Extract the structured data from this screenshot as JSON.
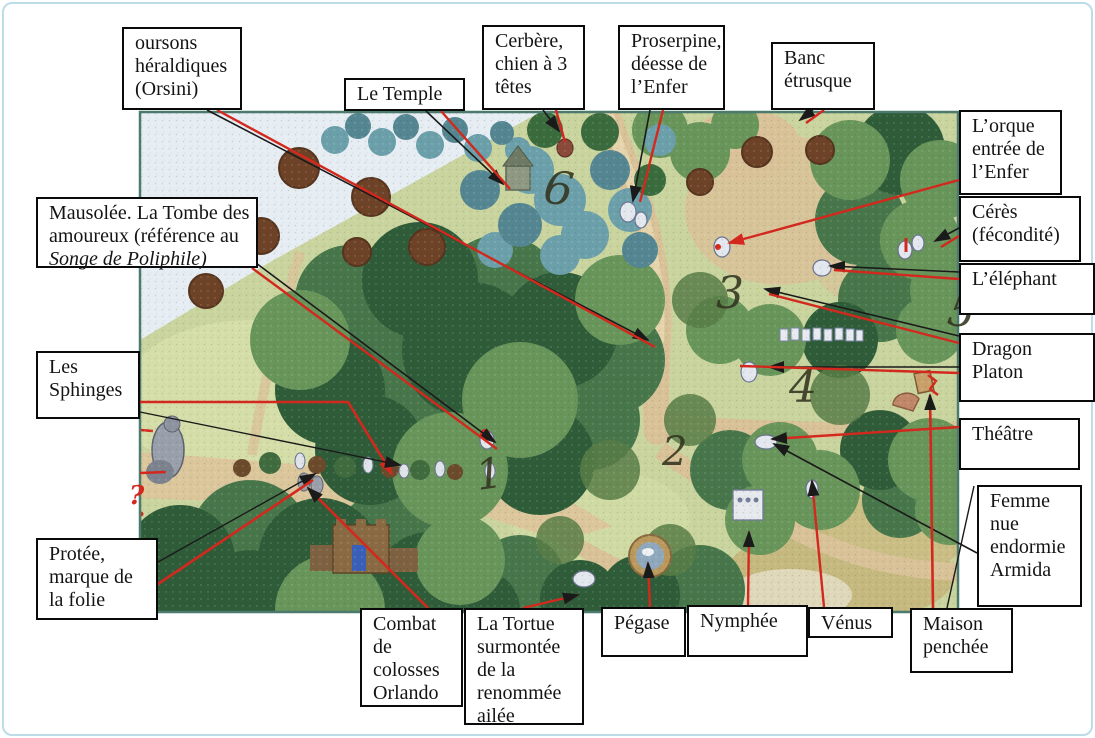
{
  "figure_type": "annotated garden map (scanned document page)",
  "colors": {
    "arrow_red": "#d3281e",
    "arrow_black": "#1a1a1a",
    "box_border": "#0a0a0a",
    "box_bg": "#ffffff",
    "frame_blue": "#bcdce9",
    "map_border": "#4d7a6e"
  },
  "map": {
    "x": 140,
    "y": 112,
    "w": 818,
    "h": 500,
    "numbers": [
      {
        "n": "1",
        "x": 478,
        "y": 490,
        "s": 42,
        "r": -8
      },
      {
        "n": "2",
        "x": 662,
        "y": 465,
        "s": 40,
        "r": 0
      },
      {
        "n": "3",
        "x": 716,
        "y": 308,
        "s": 44,
        "r": 0
      },
      {
        "n": "4",
        "x": 789,
        "y": 402,
        "s": 44,
        "r": 0
      },
      {
        "n": "5",
        "x": 946,
        "y": 324,
        "s": 42,
        "r": 10
      },
      {
        "n": "6",
        "x": 542,
        "y": 202,
        "s": 46,
        "r": 8
      }
    ],
    "question_mark": {
      "t": "?",
      "x": 129,
      "y": 504,
      "color": "#d3281e"
    }
  },
  "labels": [
    {
      "id": "oursons-heraldiques",
      "box": {
        "x": 122,
        "y": 27,
        "w": 120,
        "h": 83
      },
      "lines": [
        {
          "t": "oursons"
        },
        {
          "t": "héraldiques"
        },
        {
          "t": "(Orsini)"
        }
      ],
      "arrows": [
        {
          "c": "black",
          "w": 1.6,
          "pts": [
            [
              207,
              110
            ],
            [
              648,
              340
            ]
          ],
          "head": "black"
        },
        {
          "c": "red",
          "w": 2.4,
          "pts": [
            [
              217,
              110
            ],
            [
              655,
              347
            ]
          ],
          "head": null
        }
      ]
    },
    {
      "id": "le-temple",
      "box": {
        "x": 344,
        "y": 78,
        "w": 121,
        "h": 33
      },
      "lines": [
        {
          "t": "Le Temple"
        }
      ],
      "arrows": [
        {
          "c": "black",
          "w": 1.6,
          "pts": [
            [
              426,
              111
            ],
            [
              503,
              184
            ]
          ],
          "head": "black"
        },
        {
          "c": "red",
          "w": 2.4,
          "pts": [
            [
              441,
              111
            ],
            [
              510,
              189
            ]
          ],
          "head": null
        }
      ]
    },
    {
      "id": "cerbere",
      "box": {
        "x": 482,
        "y": 25,
        "w": 103,
        "h": 85
      },
      "lines": [
        {
          "t": "Cerbère,"
        },
        {
          "t": "chien à 3"
        },
        {
          "t": "têtes"
        }
      ],
      "arrows": [
        {
          "c": "black",
          "w": 1.6,
          "pts": [
            [
              543,
              110
            ],
            [
              559,
              131
            ]
          ],
          "head": "black"
        },
        {
          "c": "red",
          "w": 2.4,
          "pts": [
            [
              556,
              110
            ],
            [
              565,
              142
            ]
          ],
          "head": null
        }
      ]
    },
    {
      "id": "proserpine",
      "box": {
        "x": 618,
        "y": 25,
        "w": 107,
        "h": 85
      },
      "lines": [
        {
          "t": "Proserpine,"
        },
        {
          "t": "déesse de"
        },
        {
          "t": "l’Enfer"
        }
      ],
      "arrows": [
        {
          "c": "black",
          "w": 1.6,
          "pts": [
            [
              650,
              110
            ],
            [
              633,
              201
            ]
          ],
          "head": "black"
        },
        {
          "c": "red",
          "w": 2.4,
          "pts": [
            [
              663,
              110
            ],
            [
              640,
              202
            ]
          ],
          "head": null
        }
      ]
    },
    {
      "id": "banc-etrusque",
      "box": {
        "x": 771,
        "y": 42,
        "w": 104,
        "h": 68
      },
      "lines": [
        {
          "t": "Banc"
        },
        {
          "t": "étrusque"
        }
      ],
      "arrows": [
        {
          "c": "black",
          "w": 1.6,
          "pts": [
            [
              813,
              110
            ],
            [
              800,
              120
            ]
          ],
          "head": "black"
        },
        {
          "c": "red",
          "w": 2.4,
          "pts": [
            [
              824,
              110
            ],
            [
              806,
              123
            ]
          ],
          "head": null
        }
      ]
    },
    {
      "id": "l-orque",
      "box": {
        "x": 959,
        "y": 110,
        "w": 103,
        "h": 85
      },
      "lines": [
        {
          "t": "L’orque"
        },
        {
          "t": "entrée de"
        },
        {
          "t": "l’Enfer"
        }
      ],
      "arrows": [
        {
          "c": "red",
          "w": 2.4,
          "pts": [
            [
              959,
              180
            ],
            [
              729,
              243
            ]
          ],
          "head": "red"
        }
      ]
    },
    {
      "id": "ceres",
      "box": {
        "x": 959,
        "y": 196,
        "w": 122,
        "h": 66
      },
      "lines": [
        {
          "t": "Cérès"
        },
        {
          "t": "(fécondité)"
        }
      ],
      "arrows": [
        {
          "c": "black",
          "w": 1.6,
          "pts": [
            [
              959,
              228
            ],
            [
              935,
              241
            ]
          ],
          "head": "black"
        },
        {
          "c": "red",
          "w": 2.4,
          "pts": [
            [
              959,
              236
            ],
            [
              941,
              247
            ]
          ],
          "head": null
        }
      ]
    },
    {
      "id": "l-elephant",
      "box": {
        "x": 959,
        "y": 263,
        "w": 136,
        "h": 52
      },
      "lines": [
        {
          "t": "L’éléphant"
        }
      ],
      "arrows": [
        {
          "c": "black",
          "w": 1.6,
          "pts": [
            [
              959,
              272
            ],
            [
              830,
              266
            ]
          ],
          "head": "black"
        },
        {
          "c": "red",
          "w": 2.4,
          "pts": [
            [
              959,
              279
            ],
            [
              834,
              270
            ]
          ],
          "head": null
        }
      ]
    },
    {
      "id": "dragon-platon",
      "box": {
        "x": 959,
        "y": 333,
        "w": 136,
        "h": 69
      },
      "lines": [
        {
          "t": "Dragon"
        },
        {
          "t": "Platon"
        }
      ],
      "arrows": [
        {
          "c": "black",
          "w": 1.6,
          "pts": [
            [
              959,
              336
            ],
            [
              765,
              289
            ]
          ],
          "head": "black"
        },
        {
          "c": "red",
          "w": 2.4,
          "pts": [
            [
              959,
              343
            ],
            [
              769,
              294
            ]
          ],
          "head": null
        },
        {
          "c": "black",
          "w": 1.6,
          "pts": [
            [
              959,
              367
            ],
            [
              769,
              367
            ]
          ],
          "head": "black"
        },
        {
          "c": "red",
          "w": 2.4,
          "pts": [
            [
              959,
              373
            ],
            [
              740,
              366
            ]
          ],
          "head": null
        }
      ]
    },
    {
      "id": "theatre",
      "box": {
        "x": 959,
        "y": 418,
        "w": 121,
        "h": 52
      },
      "lines": [
        {
          "t": "Théâtre"
        }
      ],
      "arrows": [
        {
          "c": "red",
          "w": 2.4,
          "pts": [
            [
              959,
              427
            ],
            [
              772,
              439
            ]
          ],
          "head": "black"
        }
      ]
    },
    {
      "id": "femme-nue",
      "box": {
        "x": 977,
        "y": 485,
        "w": 105,
        "h": 122
      },
      "lines": [
        {
          "t": "Femme"
        },
        {
          "t": "nue"
        },
        {
          "t": "endormie"
        },
        {
          "t": "Armida"
        }
      ],
      "arrows": [
        {
          "c": "black",
          "w": 1.6,
          "pts": [
            [
              977,
              553
            ],
            [
              774,
              444
            ]
          ],
          "head": "black"
        }
      ]
    },
    {
      "id": "maison-penchee",
      "box": {
        "x": 910,
        "y": 608,
        "w": 103,
        "h": 65
      },
      "lines": [
        {
          "t": "Maison"
        },
        {
          "t": "penchée"
        }
      ],
      "arrows": [
        {
          "c": "red",
          "w": 2.6,
          "pts": [
            [
              933,
              608
            ],
            [
              930,
              395
            ]
          ],
          "head": "black"
        },
        {
          "c": "black",
          "w": 1.4,
          "pts": [
            [
              947,
              608
            ],
            [
              974,
              486
            ]
          ],
          "head": null
        }
      ]
    },
    {
      "id": "venus",
      "box": {
        "x": 808,
        "y": 607,
        "w": 85,
        "h": 31
      },
      "lines": [
        {
          "t": "Vénus"
        }
      ],
      "arrows": [
        {
          "c": "red",
          "w": 2.4,
          "pts": [
            [
              824,
              607
            ],
            [
              812,
              481
            ]
          ],
          "head": "black"
        }
      ]
    },
    {
      "id": "nymphee",
      "box": {
        "x": 687,
        "y": 605,
        "w": 121,
        "h": 52
      },
      "lines": [
        {
          "t": "Nymphée"
        }
      ],
      "arrows": [
        {
          "c": "red",
          "w": 2.4,
          "pts": [
            [
              748,
              605
            ],
            [
              749,
              532
            ]
          ],
          "head": "black"
        }
      ]
    },
    {
      "id": "pegase",
      "box": {
        "x": 601,
        "y": 607,
        "w": 85,
        "h": 50
      },
      "lines": [
        {
          "t": "Pégase"
        }
      ],
      "arrows": [
        {
          "c": "red",
          "w": 2.4,
          "pts": [
            [
              650,
              607
            ],
            [
              648,
              563
            ]
          ],
          "head": "black"
        }
      ]
    },
    {
      "id": "la-tortue",
      "box": {
        "x": 464,
        "y": 608,
        "w": 120,
        "h": 117
      },
      "lines": [
        {
          "t": "La Tortue"
        },
        {
          "t": "surmontée"
        },
        {
          "t": "de la"
        },
        {
          "t": "renommée"
        },
        {
          "t": "ailée"
        }
      ],
      "arrows": [
        {
          "c": "red",
          "w": 2.4,
          "pts": [
            [
              523,
              608
            ],
            [
              578,
              595
            ]
          ],
          "head": "black"
        }
      ]
    },
    {
      "id": "combat-colosses",
      "box": {
        "x": 360,
        "y": 608,
        "w": 103,
        "h": 99
      },
      "lines": [
        {
          "t": "Combat"
        },
        {
          "t": "de"
        },
        {
          "t": "colosses"
        },
        {
          "t": "Orlando"
        }
      ],
      "arrows": [
        {
          "c": "red",
          "w": 2.6,
          "pts": [
            [
              428,
              608
            ],
            [
              308,
              488
            ]
          ],
          "head": "black"
        }
      ]
    },
    {
      "id": "protee",
      "box": {
        "x": 36,
        "y": 538,
        "w": 122,
        "h": 82
      },
      "lines": [
        {
          "t": "Protée,"
        },
        {
          "t": "marque de"
        },
        {
          "t": "la folie"
        }
      ],
      "arrows": [
        {
          "c": "black",
          "w": 1.4,
          "pts": [
            [
              158,
              562
            ],
            [
              315,
              474
            ]
          ],
          "head": "black"
        },
        {
          "c": "red",
          "w": 2.6,
          "pts": [
            [
              158,
              584
            ],
            [
              313,
              480
            ]
          ],
          "head": null
        },
        {
          "c": "red",
          "w": 2.4,
          "pts": [
            [
              140,
              473
            ],
            [
              166,
              472
            ]
          ],
          "head": null
        }
      ]
    },
    {
      "id": "les-sphinges",
      "box": {
        "x": 36,
        "y": 351,
        "w": 104,
        "h": 68
      },
      "lines": [
        {
          "t": "Les"
        },
        {
          "t": "Sphinges"
        }
      ],
      "arrows": [
        {
          "c": "red",
          "w": 2.6,
          "pts": [
            [
              140,
              402
            ],
            [
              348,
              402
            ],
            [
              392,
              474
            ]
          ],
          "head": "red"
        },
        {
          "c": "black",
          "w": 1.4,
          "pts": [
            [
              140,
              412
            ],
            [
              400,
              465
            ]
          ],
          "head": "black"
        }
      ]
    },
    {
      "id": "mausolee",
      "box": {
        "x": 36,
        "y": 197,
        "w": 222,
        "h": 71
      },
      "lines": [
        {
          "t": "Mausolée. La Tombe des"
        },
        {
          "t": "amoureux (référence au"
        },
        {
          "t": "Songe de Poliphile)",
          "i": true
        }
      ],
      "arrows": [
        {
          "c": "black",
          "w": 1.6,
          "pts": [
            [
              256,
              263
            ],
            [
              495,
              442
            ]
          ],
          "head": "black"
        },
        {
          "c": "red",
          "w": 2.4,
          "pts": [
            [
              252,
              268
            ],
            [
              497,
              449
            ]
          ],
          "head": null
        }
      ]
    }
  ]
}
